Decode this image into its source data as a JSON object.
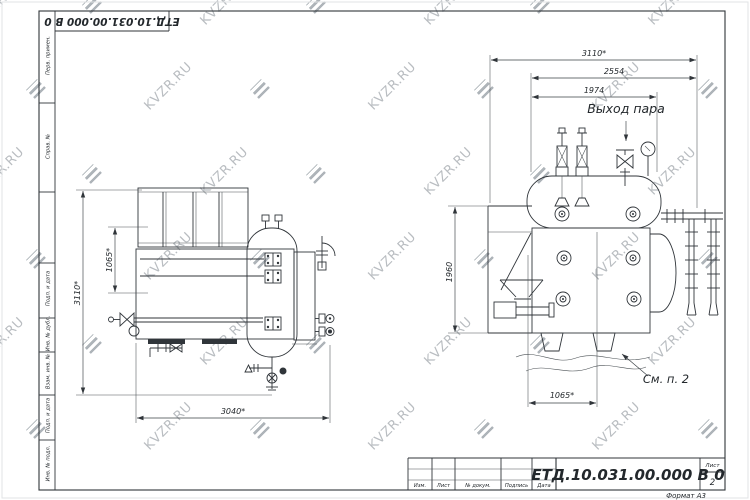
{
  "sheet": {
    "designation": "ЕТД.10.031.00.000  В 0",
    "format_label": "Формат А3",
    "watermark_text": "KVZR.RU"
  },
  "frame_labels": {
    "perv_primen": "Перв. примен.",
    "sprav_no": "Справ. №",
    "podp_data_1": "Подп. и дата",
    "inv_dubl": "Инв. № дубл.",
    "vzam_inv": "Взам. инв. №",
    "podp_data_2": "Подп. и дата",
    "inv_podl": "Инв. № подл."
  },
  "title_block": {
    "designation": "ЕТД.10.031.00.000  В 0",
    "col_izm": "Изм.",
    "col_list": "Лист",
    "col_doc": "№ докум.",
    "col_podp": "Подпись",
    "col_data": "Дата",
    "sheet_label": "Лист",
    "sheet_number": "2"
  },
  "plan_view": {
    "dim_height": "3110*",
    "dim_drum": "1065*",
    "dim_length": "3040*"
  },
  "side_view": {
    "dim_total": "3110*",
    "dim_mid": "2554",
    "dim_inner": "1974",
    "dim_height": "1960",
    "dim_base": "1065*",
    "label_steam": "Выход пара",
    "label_note": "См. п. 2"
  }
}
